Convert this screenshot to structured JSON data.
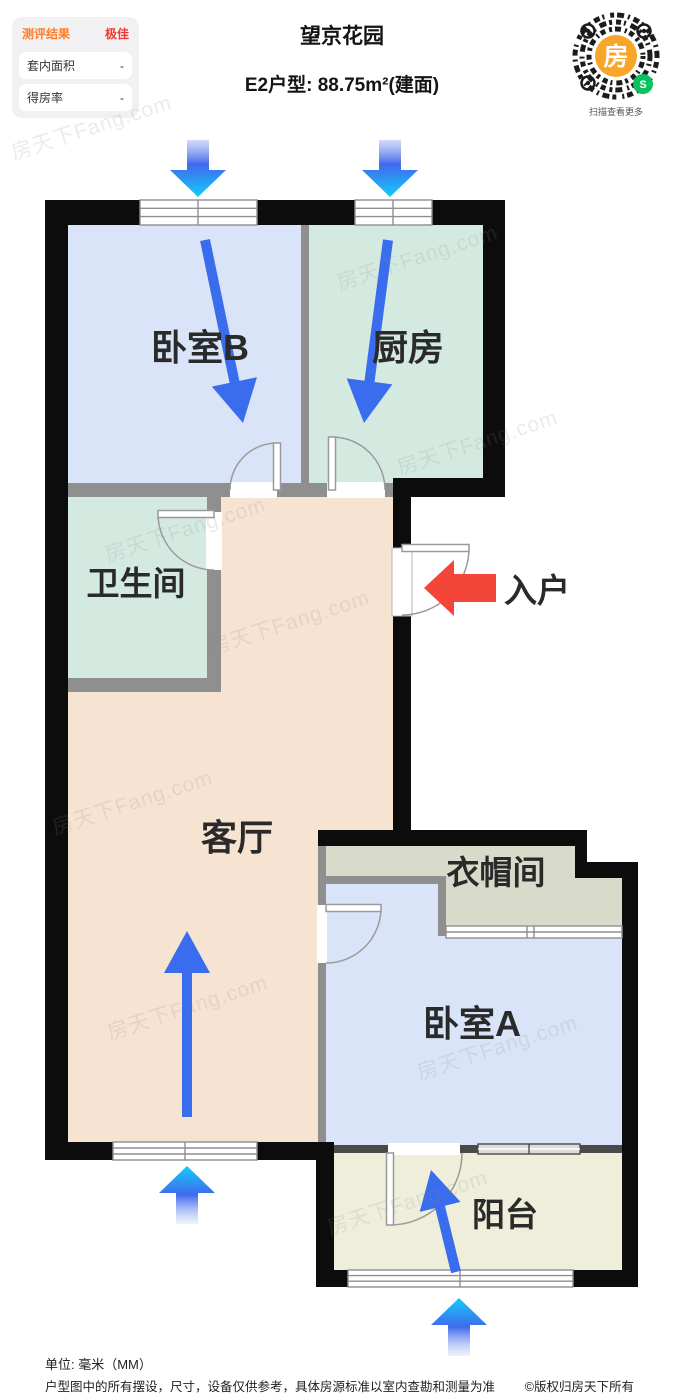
{
  "assessment_panel": {
    "title": "测评结果",
    "rating": "极佳",
    "rows": [
      {
        "label": "套内面积",
        "value": "-"
      },
      {
        "label": "得房率",
        "value": "-"
      }
    ]
  },
  "header": {
    "title": "望京花园",
    "subtitle": "E2户型: 88.75m²(建面)"
  },
  "qr_code": {
    "logo_char": "房",
    "mini_program_char": "S",
    "caption": "扫描查看更多"
  },
  "floorplan": {
    "rooms": {
      "bedroom_b": "卧室B",
      "kitchen": "厨房",
      "bathroom": "卫生间",
      "living_room": "客厅",
      "cloakroom": "衣帽间",
      "bedroom_a": "卧室A",
      "balcony": "阳台"
    },
    "entrance_label": "入户",
    "colors": {
      "bedroom": "#d9e4f8",
      "kitchen_bath": "#d4eae1",
      "living": "#f6e3d1",
      "cloakroom": "#d8dbc9",
      "balcony": "#eeeeda",
      "wall": "#0c0c0c",
      "inner_wall": "#8f8f8f",
      "arrow_blue": "#3a6cee",
      "arrow_cyan": "#12ccf9",
      "entrance_red": "#f4453b"
    }
  },
  "watermark": "房天下Fang.com",
  "footer": {
    "unit": "单位: 毫米（MM）",
    "disclaimer": "户型图中的所有摆设，尺寸，设备仅供参考，具体房源标准以室内查勘和测量为准",
    "copyright": "©版权归房天下所有"
  }
}
